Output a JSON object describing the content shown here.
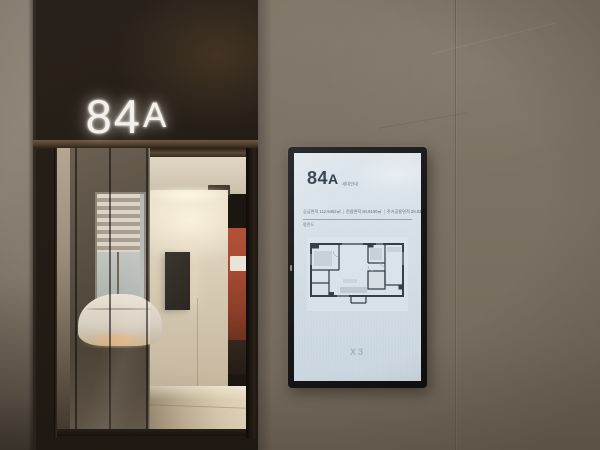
{
  "scene_description": "model-house unit entrance with illuminated door sign and vertical digital floor-plan signage",
  "door_sign": {
    "unit_number": "84",
    "unit_letter": "A"
  },
  "kiosk": {
    "title_number": "84",
    "title_letter": "A",
    "title_suffix": "세대안내",
    "specs": [
      "공급면적 112.9402㎡",
      "전용면적 84.9100㎡",
      "주거공용면적 28.0302㎡"
    ],
    "spec_divider": "|",
    "sub_label": "평면도",
    "logo_text": "X3",
    "floor_plan_name": "84A unit floor plan",
    "colors": {
      "screen_bg": "#d3dee6",
      "title_text": "#2c3b4a",
      "body_text": "#5d6d7a",
      "plan_line": "#333f49",
      "bezel": "#161617"
    }
  },
  "environment_colors": {
    "wall_stone": "#7b7164",
    "door_surround": "#241d16",
    "sign_glow": "#f4f1ea",
    "interior_wood": "#d8cdba",
    "accent_cabinet": "#a44a31"
  }
}
